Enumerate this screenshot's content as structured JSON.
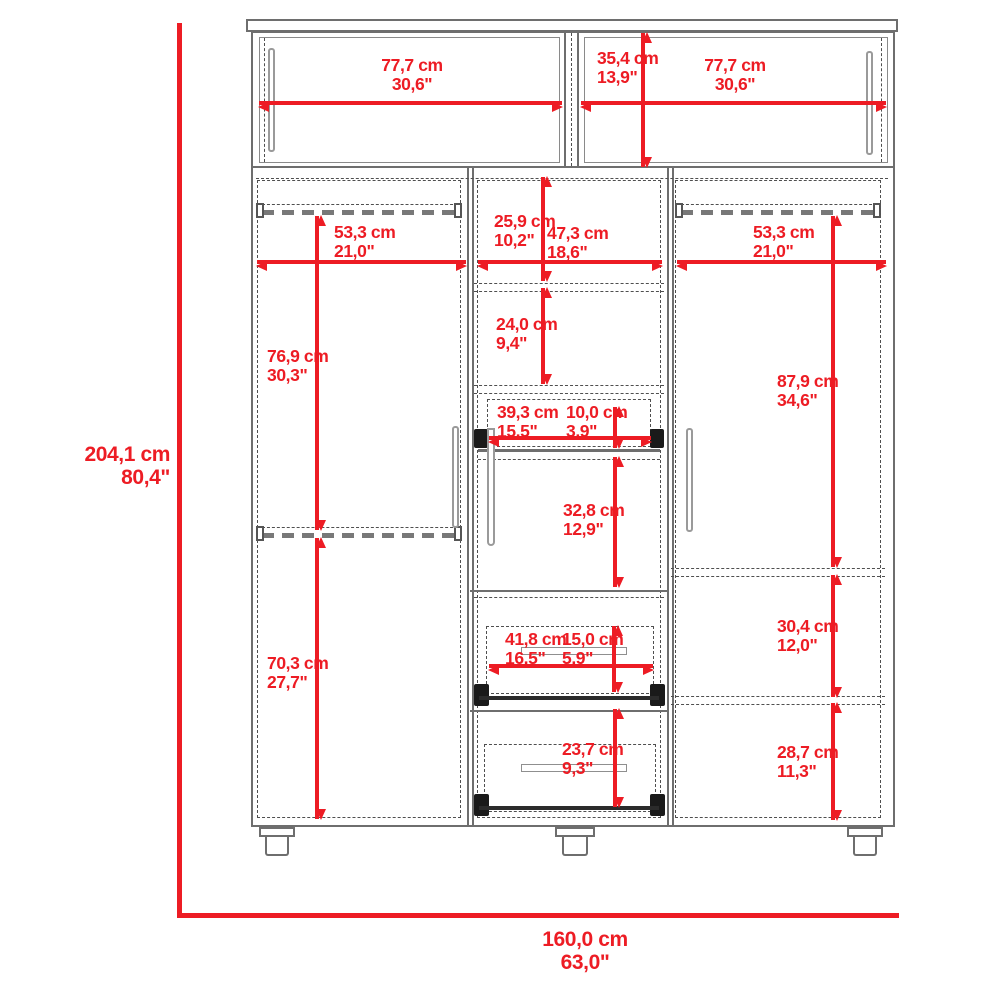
{
  "meta": {
    "title": "Wardrobe dimension diagram",
    "units_primary": "cm",
    "units_secondary": "inches"
  },
  "colors": {
    "red": "#ed1c24",
    "gray": "#6e6e6e",
    "dash": "#4f4f4f",
    "black": "#1a1a1a"
  },
  "dims": {
    "overall_height": {
      "cm": "204,1 cm",
      "in": "80,4\""
    },
    "overall_width": {
      "cm": "160,0 cm",
      "in": "63,0\""
    },
    "top_left_width": {
      "cm": "77,7 cm",
      "in": "30,6\""
    },
    "top_right_width": {
      "cm": "77,7 cm",
      "in": "30,6\""
    },
    "top_height": {
      "cm": "35,4 cm",
      "in": "13,9\""
    },
    "left_rod_width": {
      "cm": "53,3 cm",
      "in": "21,0\""
    },
    "left_upper_height": {
      "cm": "76,9 cm",
      "in": "30,3\""
    },
    "left_lower_height": {
      "cm": "70,3 cm",
      "in": "27,7\""
    },
    "mid_top_height": {
      "cm": "25,9 cm",
      "in": "10,2\""
    },
    "mid_width": {
      "cm": "47,3 cm",
      "in": "18,6\""
    },
    "mid_shelf_height": {
      "cm": "24,0 cm",
      "in": "9,4\""
    },
    "small_drawer_width": {
      "cm": "39,3 cm",
      "in": "15,5\""
    },
    "small_drawer_height": {
      "cm": "10,0 cm",
      "in": "3,9\""
    },
    "mid_cavity_height": {
      "cm": "32,8 cm",
      "in": "12,9\""
    },
    "drawer_width": {
      "cm": "41,8 cm",
      "in": "16,5\""
    },
    "drawer_height": {
      "cm": "15,0 cm",
      "in": "5,9\""
    },
    "bottom_drawer_height": {
      "cm": "23,7 cm",
      "in": "9,3\""
    },
    "right_rod_width": {
      "cm": "53,3 cm",
      "in": "21,0\""
    },
    "right_upper_height": {
      "cm": "87,9 cm",
      "in": "34,6\""
    },
    "right_middle_height": {
      "cm": "30,4 cm",
      "in": "12,0\""
    },
    "right_lower_height": {
      "cm": "28,7 cm",
      "in": "11,3\""
    }
  }
}
